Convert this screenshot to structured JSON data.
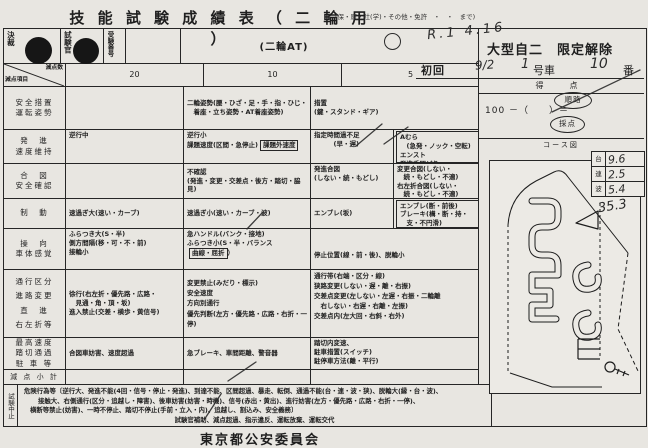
{
  "page": {
    "title": "技 能 試 験 成 績 表 （ 二 輪 用 ）",
    "title_note": "(保・原・社(学)・その他・免許　・　・　まで)",
    "footer": "東京都公安委員会"
  },
  "approval": {
    "kessai": "決裁",
    "examiner": "試験官",
    "exam_no": "受験番号",
    "vehicle_class": "(二輪AT)"
  },
  "right_header": {
    "handwritten_date": "R.1 4.16",
    "license": "大型自二　限定解除",
    "first_attempt": "初回",
    "attempt_date": "9/2",
    "car_no": "1",
    "car_suffix": "号車",
    "seat_no": "10",
    "seat_suffix": "番"
  },
  "score": {
    "label": "得　点",
    "formula": "100 －（　　）＝",
    "stamp_route": "順路",
    "stamp_grading": "採点"
  },
  "course": {
    "label": "コース図",
    "mini_table": [
      {
        "label": "台",
        "value": "9.6"
      },
      {
        "label": "連",
        "value": "2.5"
      },
      {
        "label": "波",
        "value": "5.4"
      }
    ],
    "handwritten_total": "35.3"
  },
  "table": {
    "corner_top": "減点数",
    "corner_bottom": "減点項目",
    "col20": "20",
    "col10": "10",
    "col5": "5",
    "rows": [
      {
        "label": "安全措置\n運転姿勢",
        "c20": "",
        "c10": "二輪姿勢(腰・ひざ・足・手・指・ひじ・\n　着座・立ち姿勢・AT着座姿勢)",
        "c5": "措置\n(鍵・スタンド・ギア)"
      },
      {
        "label": "発　進\n速度維持",
        "c20": "逆行中",
        "c10a": "逆行小\n課題速度(区間・急停止)",
        "c10box": "課題外速度",
        "c5l": "指定時間過不足\n　　　(早・遅)",
        "c5rbox": "Aむら\n　(急発・ノック・空転)\nエンスト\n発進手間どり"
      },
      {
        "label": "合　図\n安全確認",
        "c20": "",
        "c10": "不確認\n(発進・変更・交差点・後方・踏切・脇見)",
        "c5l": "発進合図\n(しない・続・もどし)",
        "c5r": "変更合図(しない・\n　続・もどし・不適)\n右左折合図(しない・\n　続・もどし・不適)"
      },
      {
        "label": "制　動",
        "c20": "速過ぎ大(速い・カーブ)",
        "c10": "速過ぎ小(速い・カーブ・波)",
        "c5l": "エンブレ(坂)",
        "c5rbox": "エンブレ(断・前後)\nブレーキ(構・断・持・\n　支・不円滑)"
      },
      {
        "label": "操　向\n車体感覚",
        "c20": "ふらつき大(S・半)\n側方間隔(移・可・不・前)\n接輪小",
        "c10a": "急ハンドル(バンク・接地)\nふらつき小(S・半・バランス",
        "c10box": "曲線・屈折",
        "c10b": "）",
        "c5": "停止位置(線・前・後)、脱輪小"
      },
      {
        "label": "通行区分\n進路変更\n直　進\n右左折等",
        "c20": "徐行(右左折・優先路・広路・\n　見通・角・頂・坂)\n進入禁止(交差・横歩・黄信号)",
        "c10": "変更禁止(みだり・標示)\n安全速度\n方向別通行\n優先判断(左方・優先路・広路・右折・一停)",
        "c5": "通行帯(右端・区分・線)\n狭路変更(しない・遅・離・右振)\n交差点変更(左しない・左遅・右振・二輪離\n　右しない・右遅・右離・左振)\n交差点内(左大回・右斜・右外)"
      },
      {
        "label": "最高速度\n踏切通過\n駐 車 等",
        "c20": "合図車妨害、速度超過",
        "c10": "急ブレーキ、車間距離、警音器",
        "c5": "踏切内変速、\n駐車措置(スイッチ)\n駐停車方法(離・平行)"
      },
      {
        "label": "減 点 小 計",
        "c20": "",
        "c10": "",
        "c5": ""
      }
    ]
  },
  "suspension": {
    "label": "試験中止",
    "line1": "危険行為等〔逆行大、発進不能(4回・信号・停止・発進)、到達不能、区間超過、暴走、転倒、通過不能(台・連・波・狭)、脱輪大(縁・台・波)、",
    "line2": "接触大、右側通行(区分・追越し・障害)、後車妨害(妨害・時機)、信号(赤出・黄出)、進行妨害(左方・優先路・広路・右折・一停)、",
    "line3": "横断等禁止(妨害)、一時不停止、踏切不停止(手前・立入・内)、追越し、割込み、安全義務〕",
    "line4": "試験官補助、減点超過、指示違反、運転放棄、運転交代"
  },
  "colors": {
    "paper": "#e8e6e1",
    "ink": "#1f1f1f",
    "pencil": "#2b2b2b"
  }
}
